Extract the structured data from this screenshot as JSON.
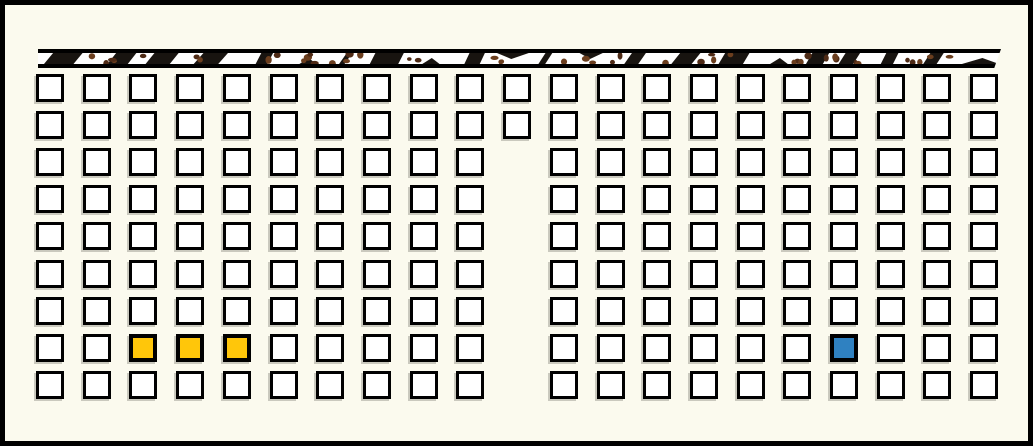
{
  "scene": {
    "description": "seating-grid diagram with textured strip at top",
    "background_color": "#FBFAEE",
    "outer_border_color": "#000000"
  },
  "top_strip": {
    "name": "textured-wall-strip",
    "band_fill": "#FFFFFF",
    "border_color": "#000000",
    "dash_color": "#181410",
    "dot_color": "#4E2A15",
    "dot_color_alt": "#6B3E1E"
  },
  "grid": {
    "rows": 9,
    "columns": 21,
    "partial_column": {
      "column": 11,
      "rows_present": [
        1,
        2
      ]
    },
    "cell_fill": "#FFFFFF",
    "cell_border_color": "#000000",
    "highlighted": [
      {
        "row": 8,
        "col": 3,
        "color": "#FFC60A",
        "name": "yellow-seat-1"
      },
      {
        "row": 8,
        "col": 4,
        "color": "#FFC60A",
        "name": "yellow-seat-2"
      },
      {
        "row": 8,
        "col": 5,
        "color": "#FFC60A",
        "name": "yellow-seat-3"
      },
      {
        "row": 8,
        "col": 18,
        "color": "#2F81C1",
        "name": "blue-seat"
      }
    ]
  }
}
